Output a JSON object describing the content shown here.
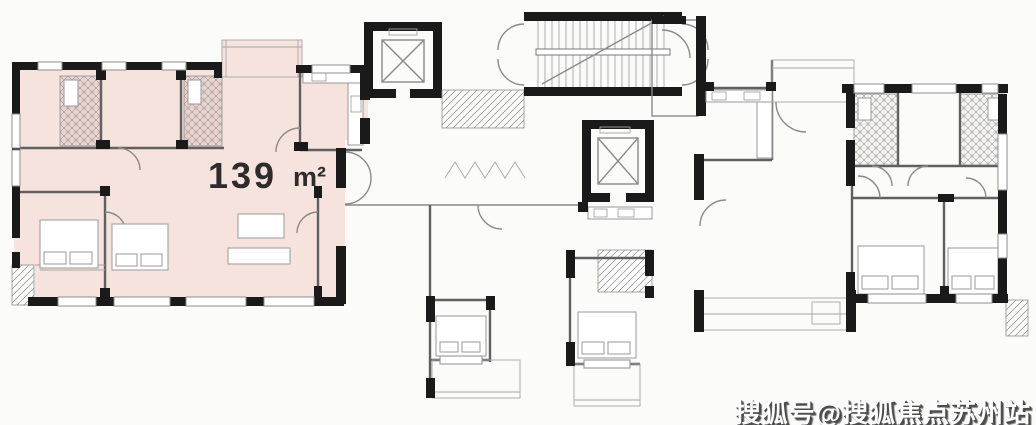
{
  "theme": {
    "bg": "#fbfbfa",
    "wall": "#1a1a1a",
    "line": "#8a8a8a",
    "line-dark": "#606060",
    "highlight": "#f7e3de",
    "highlight-deep": "#f1d8d2",
    "label": "#2c2c2c",
    "watermark-shadow": "#4c4c4c"
  },
  "plan": {
    "area_value": "139",
    "area_unit": "m²"
  },
  "watermark": {
    "text": "搜狐号@搜狐焦点苏州站"
  }
}
